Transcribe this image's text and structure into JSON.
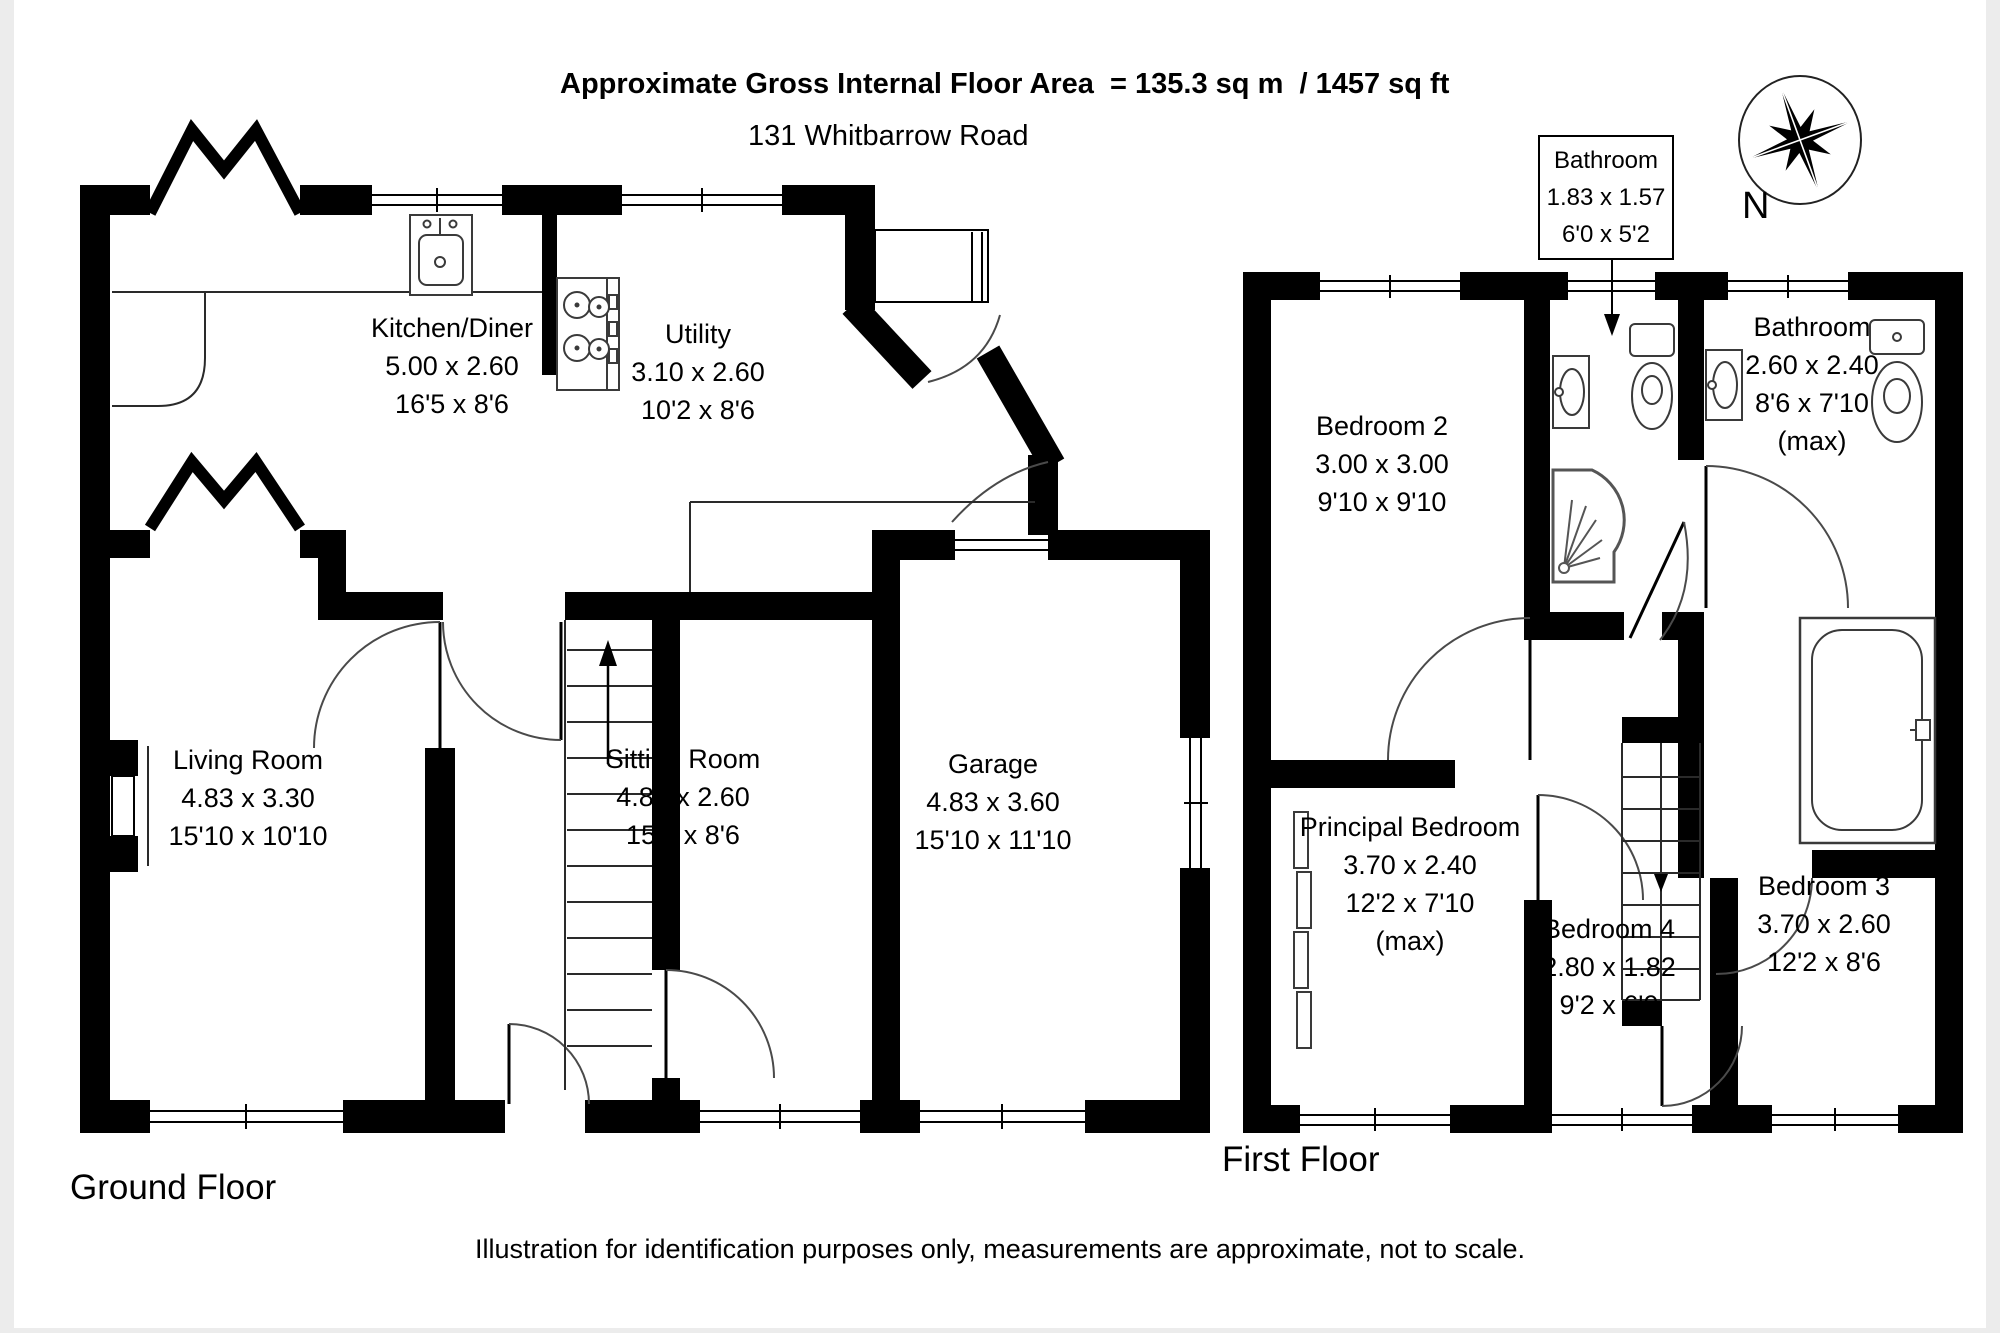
{
  "header": {
    "title": "Approximate Gross Internal Floor Area  = 135.3 sq m  / 1457 sq ft",
    "address": "131 Whitbarrow Road"
  },
  "compass": {
    "north_label": "N"
  },
  "floors": {
    "ground": {
      "label": "Ground Floor",
      "rooms": {
        "kitchen_diner": {
          "name": "Kitchen/Diner",
          "metric": "5.00 x 2.60",
          "imperial": "16'5 x 8'6"
        },
        "utility": {
          "name": "Utility",
          "metric": "3.10 x 2.60",
          "imperial": "10'2 x 8'6"
        },
        "living_room": {
          "name": "Living Room",
          "metric": "4.83 x 3.30",
          "imperial": "15'10 x 10'10"
        },
        "sitting_room": {
          "name": "Sitting Room",
          "metric": "4.80 x 2.60",
          "imperial": "15'9 x 8'6"
        },
        "garage": {
          "name": "Garage",
          "metric": "4.83 x 3.60",
          "imperial": "15'10 x 11'10"
        }
      }
    },
    "first": {
      "label": "First Floor",
      "rooms": {
        "bedroom_2": {
          "name": "Bedroom 2",
          "metric": "3.00 x 3.00",
          "imperial": "9'10 x 9'10"
        },
        "bathroom_callout": {
          "name": "Bathroom",
          "metric": "1.83 x 1.57",
          "imperial": "6'0 x 5'2"
        },
        "bathroom": {
          "name": "Bathroom",
          "metric": "2.60 x 2.40",
          "imperial": "8'6 x 7'10",
          "qualifier": "(max)"
        },
        "principal_bedroom": {
          "name": "Principal Bedroom",
          "metric": "3.70 x 2.40",
          "imperial": "12'2 x 7'10",
          "qualifier": "(max)"
        },
        "bedroom_4": {
          "name": "Bedroom 4",
          "metric": "2.80 x 1.82",
          "imperial": "9'2 x 6'0"
        },
        "bedroom_3": {
          "name": "Bedroom 3",
          "metric": "3.70 x 2.60",
          "imperial": "12'2 x 8'6"
        }
      }
    }
  },
  "footer": {
    "disclaimer": "Illustration for identification purposes only, measurements are approximate, not to scale."
  }
}
